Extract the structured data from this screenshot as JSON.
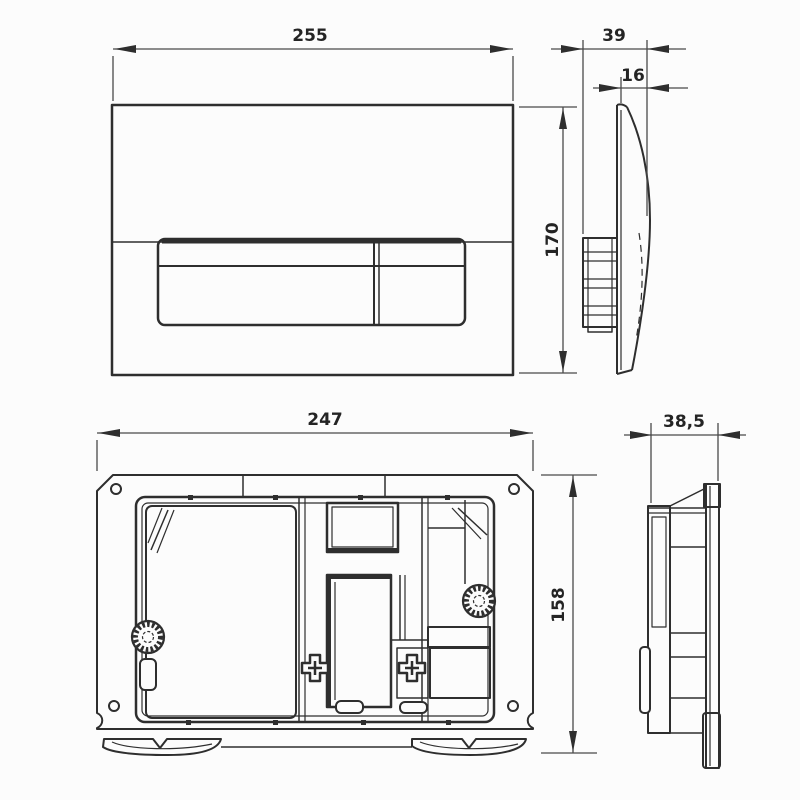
{
  "drawing": {
    "type": "technical-dimension-drawing",
    "views": {
      "plate_front": "flush plate front view",
      "plate_side": "flush plate side view",
      "frame_front": "mounting frame front view",
      "frame_side": "mounting frame side view"
    }
  },
  "dimensions": {
    "plate_width": "255",
    "plate_depth": "39",
    "plate_thickness": "16",
    "plate_height": "170",
    "frame_width": "247",
    "frame_depth": "38,5",
    "frame_height": "158"
  },
  "colors": {
    "line": "#2e2e2e",
    "line_soft": "#4a4a4a",
    "background": "#fcfcfc",
    "text": "#242424"
  }
}
